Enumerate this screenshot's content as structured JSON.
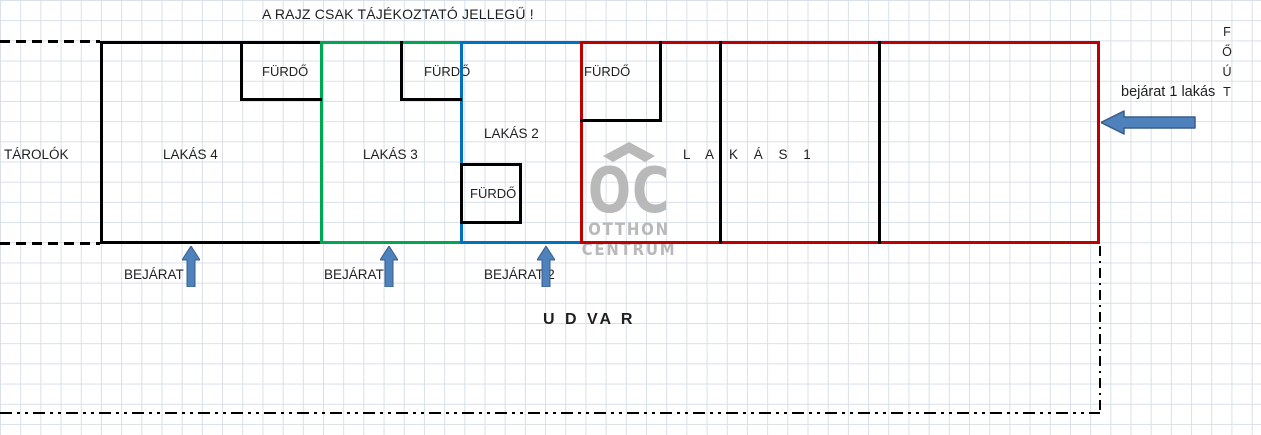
{
  "title": "A RAJZ CSAK TÁJÉKOZTATÓ JELLEGŰ !",
  "plan": {
    "storage_label": "TÁROLÓK",
    "courtyard_label": "U D VA R",
    "units": [
      {
        "label": "L A K Á S  1",
        "bath_label": "FÜRDŐ"
      },
      {
        "label": "LAKÁS 2",
        "bath_label": "FÜRDŐ"
      },
      {
        "label": "LAKÁS 3",
        "bath_label": "FÜRDŐ"
      },
      {
        "label": "LAKÁS 4",
        "bath_label": "FÜRDŐ"
      }
    ],
    "entrances": {
      "entrance_4": "BEJÁRAT",
      "entrance_3": "BEJÁRAT",
      "entrance_2": "BEJÁRAT 2",
      "entrance_1": "bejárat 1 lakás"
    },
    "main_road_letters": [
      "F",
      "Ő",
      "Ú",
      "T"
    ]
  },
  "watermark": {
    "logo_text": "OC",
    "line1": "OTTHON",
    "line2": "CENTRUM"
  },
  "colors": {
    "unit1_outline": "#C00000",
    "unit2_outline": "#0070C0",
    "unit3_outline": "#00A651",
    "wall": "#000000",
    "arrow_fill": "#4F81BD",
    "arrow_border": "#385D8A",
    "watermark_gray": "#B9B9B9",
    "grid_line": "#D9E0E9"
  }
}
